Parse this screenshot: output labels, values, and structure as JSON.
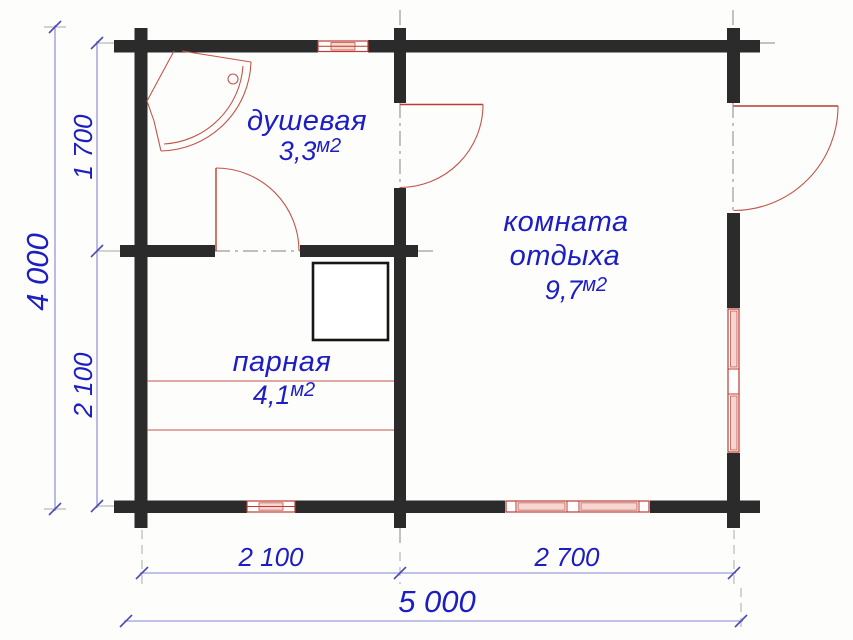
{
  "plan_type": "floor-plan",
  "rooms": [
    {
      "id": "shower",
      "name": "душевая",
      "area": "3,3",
      "unit": "м2"
    },
    {
      "id": "rest",
      "name_line1": "комната",
      "name_line2": "отдыха",
      "area": "9,7",
      "unit": "м2"
    },
    {
      "id": "steam",
      "name": "парная",
      "area": "4,1",
      "unit": "м2"
    }
  ],
  "dimensions": {
    "overall_height": "4 000",
    "left_top": "1 700",
    "left_bottom": "2 100",
    "bottom_left": "2 100",
    "bottom_right": "2 700",
    "overall_width": "5 000"
  },
  "colors": {
    "wall": "#2b2b2b",
    "fixture_red": "#bf3a2f",
    "label_blue": "#1d1dc4",
    "dimension_blue": "#8585d4",
    "centerline_gray": "#9a9a9a",
    "window_fill": "#f5d6d1",
    "background": "#fdfdfc"
  }
}
